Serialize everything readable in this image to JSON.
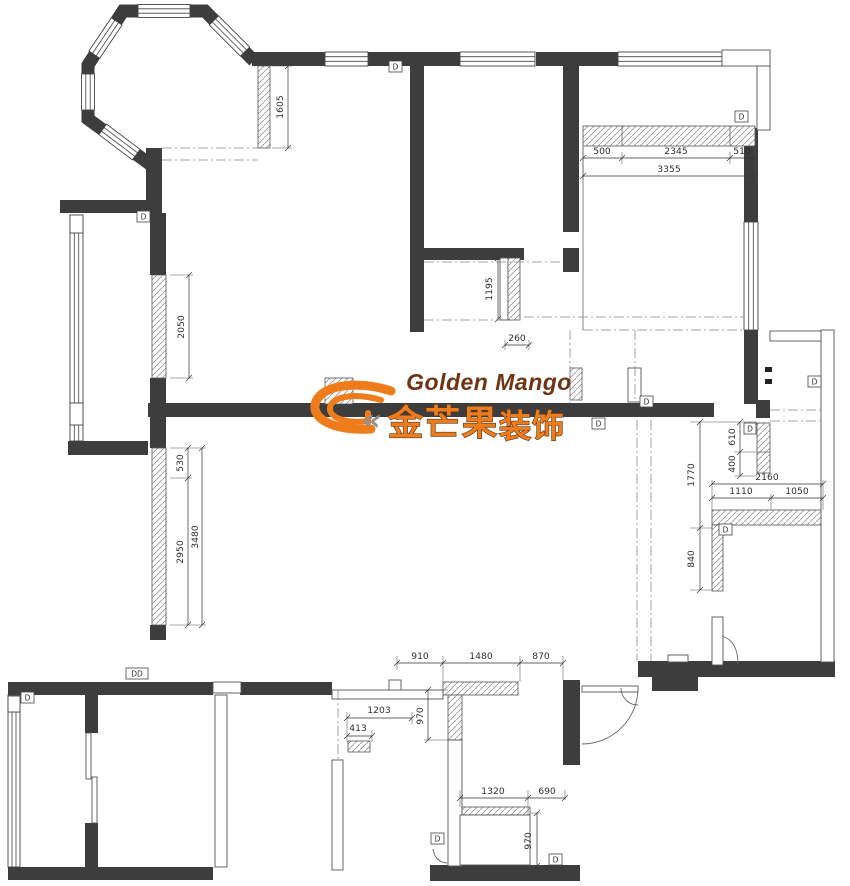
{
  "logo": {
    "name_en": "Golden Mango",
    "name_zh": "金芒果",
    "type_zh": "装饰",
    "chevron": "«"
  },
  "labels": {
    "door": "D",
    "door_double": "DD"
  },
  "colors": {
    "wall": "#3d3d3d",
    "logo_orange": "#ef7c1a",
    "logo_brown": "#6f3414",
    "logo_outline": "#533820",
    "dim_text": "#2f2f2f",
    "line": "#555555"
  },
  "dimensions": [
    {
      "id": "bay-right-window",
      "value": "1605",
      "orientation": "vertical"
    },
    {
      "id": "top-right-seg1",
      "value": "500",
      "orientation": "horizontal"
    },
    {
      "id": "top-right-seg2",
      "value": "2345",
      "orientation": "horizontal"
    },
    {
      "id": "top-right-seg3",
      "value": "510",
      "orientation": "horizontal"
    },
    {
      "id": "top-right-total",
      "value": "3355",
      "orientation": "horizontal"
    },
    {
      "id": "mid-partition",
      "value": "1195",
      "orientation": "vertical"
    },
    {
      "id": "mid-offset",
      "value": "260",
      "orientation": "horizontal"
    },
    {
      "id": "left-window-upper",
      "value": "2050",
      "orientation": "vertical"
    },
    {
      "id": "left-lower-seg1",
      "value": "530",
      "orientation": "vertical"
    },
    {
      "id": "left-lower-seg2",
      "value": "2950",
      "orientation": "vertical"
    },
    {
      "id": "left-lower-total",
      "value": "3480",
      "orientation": "vertical"
    },
    {
      "id": "right-room",
      "value": "1770",
      "orientation": "vertical"
    },
    {
      "id": "right-strip-seg1",
      "value": "610",
      "orientation": "vertical"
    },
    {
      "id": "right-strip-seg2",
      "value": "400",
      "orientation": "vertical"
    },
    {
      "id": "right-total",
      "value": "2160",
      "orientation": "horizontal"
    },
    {
      "id": "right-seg1",
      "value": "1110",
      "orientation": "horizontal"
    },
    {
      "id": "right-seg2",
      "value": "1050",
      "orientation": "horizontal"
    },
    {
      "id": "right-leg",
      "value": "840",
      "orientation": "vertical"
    },
    {
      "id": "bottom-opening-left",
      "value": "910",
      "orientation": "horizontal"
    },
    {
      "id": "bottom-wall",
      "value": "1480",
      "orientation": "horizontal"
    },
    {
      "id": "bottom-opening-right",
      "value": "870",
      "orientation": "horizontal"
    },
    {
      "id": "bottom-leg",
      "value": "970",
      "orientation": "vertical"
    },
    {
      "id": "bottom-left-seg1",
      "value": "1203",
      "orientation": "horizontal"
    },
    {
      "id": "bottom-left-seg2",
      "value": "413",
      "orientation": "horizontal"
    },
    {
      "id": "bottom-right-seg1",
      "value": "1320",
      "orientation": "horizontal"
    },
    {
      "id": "bottom-right-seg2",
      "value": "690",
      "orientation": "horizontal"
    },
    {
      "id": "bottom-right-leg",
      "value": "970",
      "orientation": "vertical"
    }
  ]
}
